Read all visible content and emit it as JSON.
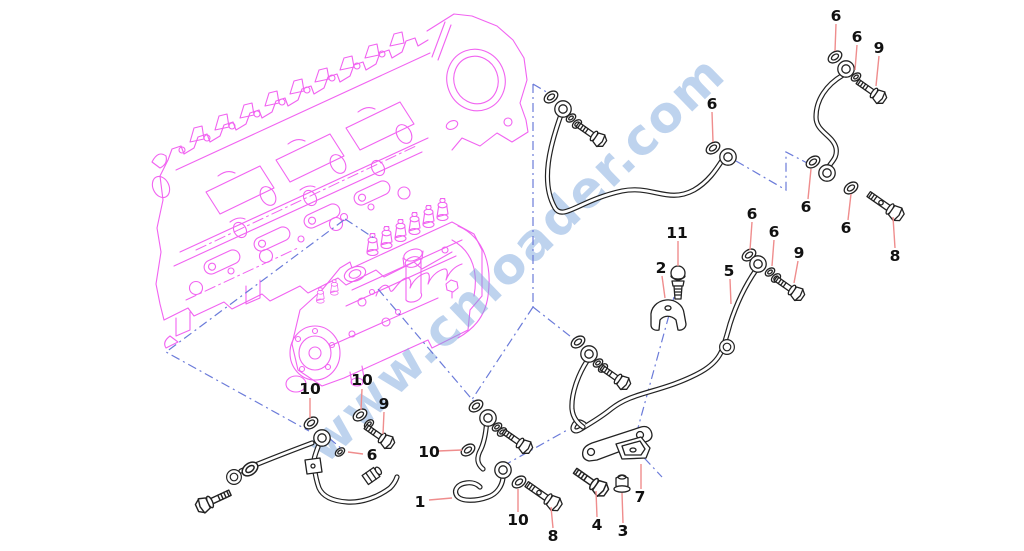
{
  "diagram": {
    "watermark": {
      "text": "www.cnloader.com"
    },
    "colors": {
      "background": "#ffffff",
      "engine_art": "#f163f1",
      "black_parts": "#222222",
      "assembly_line": "#6b7bd9",
      "leader_line": "#ef8d8d",
      "label_text": "#111111",
      "watermark": "#7da8de"
    },
    "callouts": [
      {
        "label": "6",
        "x": 836,
        "y": 16,
        "leader": [
          836,
          24,
          835,
          51
        ]
      },
      {
        "label": "6",
        "x": 857,
        "y": 37,
        "leader": [
          857,
          45,
          855,
          70
        ]
      },
      {
        "label": "9",
        "x": 879,
        "y": 48,
        "leader": [
          879,
          56,
          876,
          86
        ]
      },
      {
        "label": "6",
        "x": 712,
        "y": 104,
        "leader": [
          712,
          112,
          713,
          142
        ]
      },
      {
        "label": "6",
        "x": 806,
        "y": 207,
        "leader": [
          808,
          199,
          811,
          169
        ]
      },
      {
        "label": "6",
        "x": 846,
        "y": 228,
        "leader": [
          848,
          220,
          851,
          194
        ]
      },
      {
        "label": "8",
        "x": 895,
        "y": 256,
        "leader": [
          895,
          248,
          893,
          217
        ]
      },
      {
        "label": "6",
        "x": 752,
        "y": 214,
        "leader": [
          752,
          222,
          750,
          250
        ]
      },
      {
        "label": "6",
        "x": 774,
        "y": 232,
        "leader": [
          774,
          240,
          772,
          266
        ]
      },
      {
        "label": "9",
        "x": 799,
        "y": 253,
        "leader": [
          798,
          261,
          794,
          283
        ]
      },
      {
        "label": "11",
        "x": 677,
        "y": 233,
        "leader": [
          678,
          241,
          678,
          266
        ]
      },
      {
        "label": "2",
        "x": 661,
        "y": 268,
        "leader": [
          662,
          276,
          665,
          298
        ]
      },
      {
        "label": "5",
        "x": 729,
        "y": 271,
        "leader": [
          730,
          279,
          731,
          304
        ]
      },
      {
        "label": "10",
        "x": 310,
        "y": 389,
        "leader": [
          310,
          398,
          310,
          418
        ]
      },
      {
        "label": "10",
        "x": 362,
        "y": 380,
        "leader": [
          362,
          389,
          361,
          410
        ]
      },
      {
        "label": "9",
        "x": 384,
        "y": 404,
        "leader": [
          384,
          412,
          383,
          434
        ]
      },
      {
        "label": "6",
        "x": 372,
        "y": 455,
        "leader": [
          363,
          454,
          348,
          452
        ]
      },
      {
        "label": "10",
        "x": 429,
        "y": 452,
        "leader": [
          438,
          451,
          462,
          450
        ]
      },
      {
        "label": "1",
        "x": 420,
        "y": 502,
        "leader": [
          429,
          500,
          452,
          498
        ]
      },
      {
        "label": "10",
        "x": 518,
        "y": 520,
        "leader": [
          518,
          512,
          518,
          489
        ]
      },
      {
        "label": "8",
        "x": 553,
        "y": 536,
        "leader": [
          553,
          528,
          551,
          507
        ]
      },
      {
        "label": "4",
        "x": 597,
        "y": 525,
        "leader": [
          597,
          517,
          596,
          491
        ]
      },
      {
        "label": "3",
        "x": 623,
        "y": 531,
        "leader": [
          623,
          523,
          622,
          493
        ]
      },
      {
        "label": "7",
        "x": 640,
        "y": 497,
        "leader": [
          641,
          489,
          641,
          464
        ]
      }
    ]
  }
}
